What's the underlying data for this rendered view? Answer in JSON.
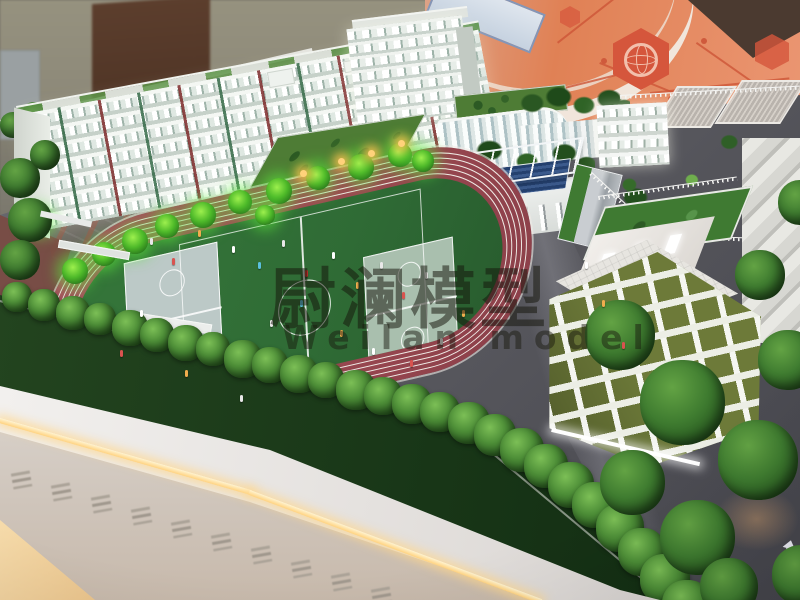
{
  "title": "School campus architectural scale model on illuminated display plinth",
  "watermark": {
    "title": "尉澜模型",
    "subtitle": "Weilan model"
  },
  "background": {
    "left_wall": "exhibition room wall",
    "door": "dark wooden door",
    "right_wall": "orange mural with network graphic",
    "mural_icons": [
      "globe-icon",
      "hexagon-icon",
      "network-lines",
      "white-arc-band"
    ]
  },
  "model": {
    "buildings": [
      {
        "name": "dormitory-building",
        "desc": "long white multi-storey block, windows lit, colored panels"
      },
      {
        "name": "tower-building",
        "desc": "white mid-rise tower with lit window grid"
      },
      {
        "name": "green-roof-blocks",
        "desc": "low classroom blocks with rooftop gardens and glass facades"
      },
      {
        "name": "grandstand",
        "desc": "canopied stand with dark-blue bleachers beside the track"
      },
      {
        "name": "rooftop-garden-terrace",
        "desc": "lawn terrace with shrubs, white balustrade and ribbed roofs"
      },
      {
        "name": "green-wave-building",
        "desc": "olive facade with wavy white bands, lit windows, tiled roof terrace"
      }
    ],
    "sports": {
      "track": "red oval running track with white lane lines",
      "pitch": "green football pitch with white markings and centre circle",
      "courts": "two light basketball courts inside the infield",
      "figures": "miniature people on field, track and paths"
    },
    "landscape": {
      "trees": "model trees, several with bright green uplights and amber lamps",
      "hedge": "perimeter tree row along the model edge"
    },
    "base": {
      "plinth": "white display plinth",
      "led": "warm LED light strip",
      "relief": "raised calligraphy relief (illegible)",
      "floor": "warm-lit exhibition floor at corner"
    }
  },
  "colors": {
    "wall-beige": "#8f8a7c",
    "door-brown": "#4e3428",
    "mural-orange": "#e08155",
    "mural-accent": "#cf5a3c",
    "track-red": "#9d4a52",
    "lane-white": "#efe9e4",
    "field-green": "#2f6b35",
    "court-blue": "#bcc9c7",
    "court-green": "#a9bfae",
    "building-white": "#eef2ee",
    "bleacher-blue": "#2c4a78",
    "olive-green": "#6d7a39",
    "lawn-green": "#4c8a3e",
    "tree-green": "#2d5a26",
    "glow-green": "#52e02e",
    "base-green": "#183617",
    "plinth-white": "#e9e6e4",
    "led-warm": "#ffd88f",
    "floor-warm": "#eccf9e",
    "road-gray": "#55555d",
    "plaza-brick": "#7a4a40",
    "watermark-dark": "rgba(22,22,12,0.52)"
  }
}
